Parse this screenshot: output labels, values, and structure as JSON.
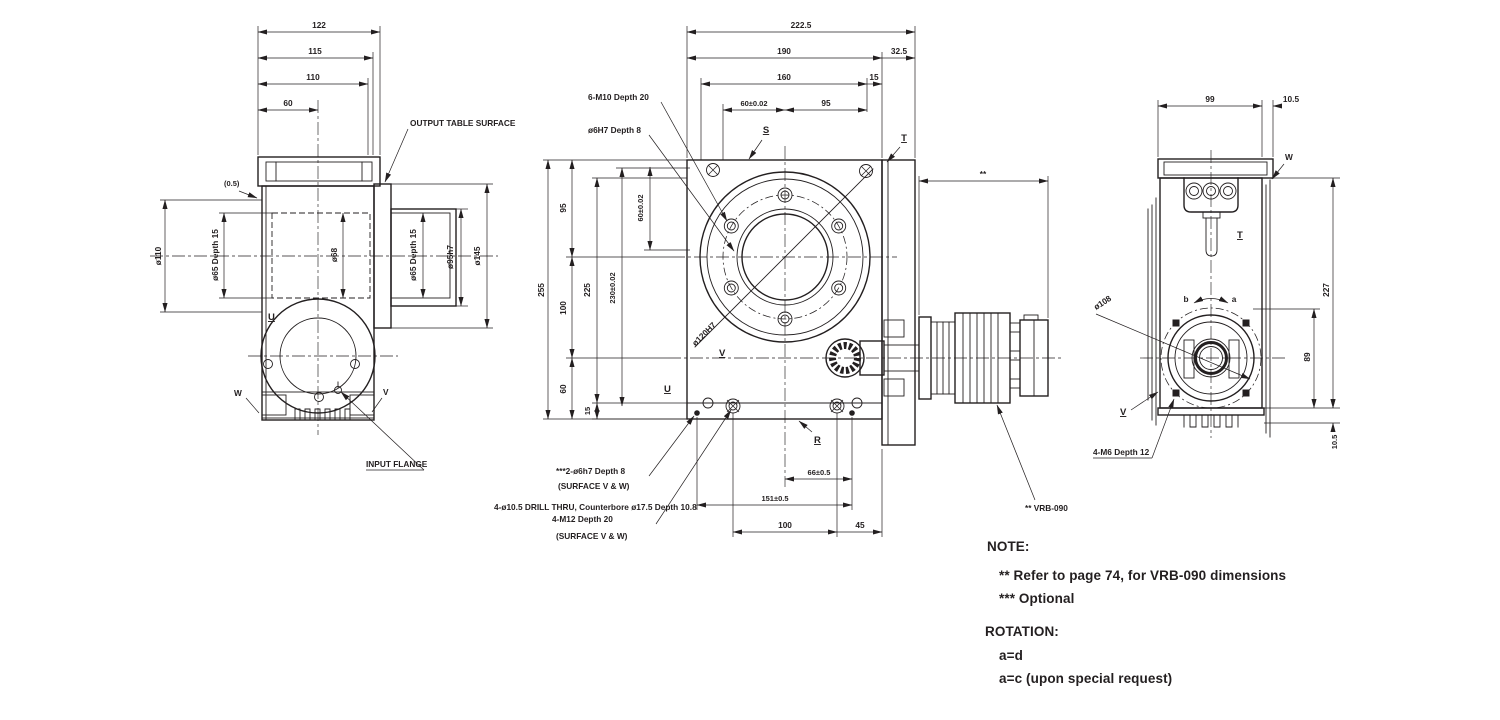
{
  "colors": {
    "ink": "#231f20",
    "background": "#ffffff"
  },
  "left_view": {
    "dim_122": "122",
    "dim_115": "115",
    "dim_110": "110",
    "dim_60": "60",
    "dim_gap": "(0.5)",
    "dim_d110": "ø110",
    "dim_d65_depth15": "ø65 Depth 15",
    "dim_d68": "ø68",
    "dim_d95h7": "ø95h7",
    "dim_d145": "ø145",
    "label_output_table_surface": "OUTPUT TABLE SURFACE",
    "label_input_flange": "INPUT FLANGE",
    "label_u": "U",
    "label_w": "W",
    "label_v": "V"
  },
  "front_view": {
    "dim_222_5": "222.5",
    "dim_190": "190",
    "dim_32_5": "32.5",
    "dim_160": "160",
    "dim_15_top": "15",
    "dim_60_tol": "60±0.02",
    "dim_95_top": "95",
    "callout_6_m10": "6-M10 Depth 20",
    "callout_d6h7": "ø6H7 Depth 8",
    "label_s": "S",
    "label_t": "T",
    "dim_255": "255",
    "dim_95_left": "95",
    "dim_100_left": "100",
    "dim_60_left": "60",
    "dim_15_left": "15",
    "dim_225": "225",
    "dim_230_tol": "230±0.02",
    "dim_60_tol_v": "60±0.02",
    "label_d120h7": "ø120H7",
    "label_u": "U",
    "label_v": "V",
    "label_r": "R",
    "dim_66_tol": "66±0.5",
    "dim_151_tol": "151±0.5",
    "dim_100_bottom": "100",
    "dim_45": "45",
    "callout_dowel": "***2-ø6h7 Depth 8",
    "callout_surface_vw": "(SURFACE V & W)",
    "callout_drill": "4-ø10.5 DRILL THRU, Counterbore ø17.5 Depth 10.8",
    "callout_m12": "4-M12 Depth 20",
    "dim_star": "**",
    "callout_vrb": "** VRB-090"
  },
  "right_view": {
    "dim_99": "99",
    "dim_10_5_top": "10.5",
    "dim_227": "227",
    "dim_89": "89",
    "dim_10_5_bottom": "10.5",
    "label_w": "W",
    "label_t": "T",
    "label_b": "b",
    "label_a": "a",
    "label_v": "V",
    "label_d108": "ø108",
    "callout_4_m6": "4-M6 Depth 12"
  },
  "notes": {
    "note_title": "NOTE:",
    "note_vrb": "** Refer to page 74, for VRB-090 dimensions",
    "note_optional": "*** Optional",
    "rotation_title": "ROTATION:",
    "rotation_standard": "a=d",
    "rotation_special": "a=c (upon special request)"
  }
}
